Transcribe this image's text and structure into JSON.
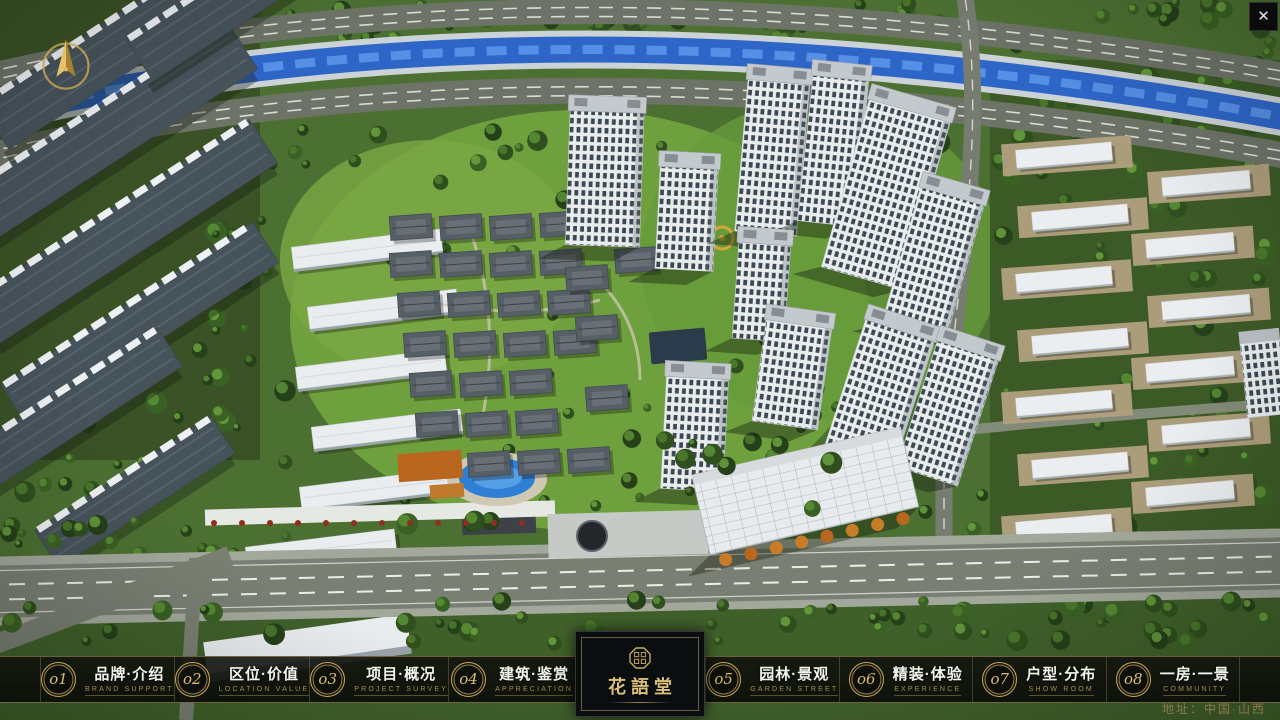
{
  "window": {
    "close_glyph": "✕"
  },
  "logo": {
    "name": "花語堂"
  },
  "footer": {
    "address": "地址：中国·山西"
  },
  "menu": {
    "items": [
      {
        "num": "o1",
        "title": "品牌·介绍",
        "subtitle": "BRAND SUPPORT"
      },
      {
        "num": "o2",
        "title": "区位·价值",
        "subtitle": "LOCATION VALUE"
      },
      {
        "num": "o3",
        "title": "项目·概况",
        "subtitle": "PROJECT SURVEY"
      },
      {
        "num": "o4",
        "title": "建筑·鉴赏",
        "subtitle": "APPRECIATION"
      },
      {
        "num": "o5",
        "title": "园林·景观",
        "subtitle": "GARDEN STREET"
      },
      {
        "num": "o6",
        "title": "精装·体验",
        "subtitle": "EXPERIENCE"
      },
      {
        "num": "o7",
        "title": "户型·分布",
        "subtitle": "SHOW ROOM"
      },
      {
        "num": "o8",
        "title": "一房·一景",
        "subtitle": "COMMUNITY"
      }
    ]
  }
}
